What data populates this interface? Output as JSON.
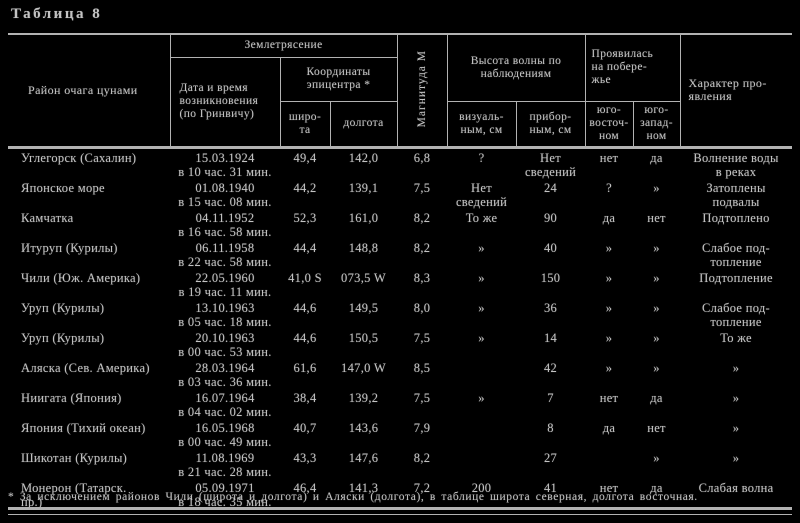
{
  "title": "Таблица 8",
  "colors": {
    "background": "#000000",
    "ink": "#c3c3c3",
    "rule": "#b2b2b2"
  },
  "header": {
    "region": "Район очага цунами",
    "earthquake_group": "Землетрясение",
    "datetime": "Дата и время\nвозникновения\n(по Гринвичу)",
    "coords_group": "Координаты\nэпицентра *",
    "lat": "широ-\nта",
    "lon": "долгота",
    "magnitude": "Магнитуда М",
    "height_group": "Высота волны по\nнаблюдениям",
    "visual": "визуаль-\nным, см",
    "instrumental": "прибор-\nным, см",
    "coast_group": "Проявилась\nна побере-\nжье",
    "southeast": "юго-\nвосточ-\nном",
    "southwest": "юго-\nзапад-\nном",
    "character": "Характер про-\nявления"
  },
  "rows": [
    {
      "region": "Углегорск (Сахалин)",
      "datetime": "15.03.1924\nв 10 час. 31 мин.",
      "lat": "49,4",
      "lon": "142,0",
      "mag": "6,8",
      "visual": "?",
      "instr": "Нет\nсведений",
      "se": "нет",
      "sw": "да",
      "character": "Волнение воды\nв реках"
    },
    {
      "region": "Японское море",
      "datetime": "01.08.1940\nв 15 час. 08 мин.",
      "lat": "44,2",
      "lon": "139,1",
      "mag": "7,5",
      "visual": "Нет\nсведений",
      "instr": "24",
      "se": "?",
      "sw": "»",
      "character": "Затоплены\nподвалы"
    },
    {
      "region": "Камчатка",
      "datetime": "04.11.1952\nв 16 час. 58 мин.",
      "lat": "52,3",
      "lon": "161,0",
      "mag": "8,2",
      "visual": "То же",
      "instr": "90",
      "se": "да",
      "sw": "нет",
      "character": "Подтоплено"
    },
    {
      "region": "Итуруп (Курилы)",
      "datetime": "06.11.1958\nв 22 час. 58 мин.",
      "lat": "44,4",
      "lon": "148,8",
      "mag": "8,2",
      "visual": "»",
      "instr": "40",
      "se": "»",
      "sw": "»",
      "character": "Слабое под-\nтопление"
    },
    {
      "region": "Чили (Юж. Америка)",
      "datetime": "22.05.1960\nв 19 час. 11 мин.",
      "lat": "41,0 S",
      "lon": "073,5 W",
      "mag": "8,3",
      "visual": "»",
      "instr": "150",
      "se": "»",
      "sw": "»",
      "character": "Подтопление"
    },
    {
      "region": "Уруп (Курилы)",
      "datetime": "13.10.1963\nв 05 час. 18 мин.",
      "lat": "44,6",
      "lon": "149,5",
      "mag": "8,0",
      "visual": "»",
      "instr": "36",
      "se": "»",
      "sw": "»",
      "character": "Слабое под-\nтопление"
    },
    {
      "region": "Уруп (Курилы)",
      "datetime": "20.10.1963\nв 00 час. 53 мин.",
      "lat": "44,6",
      "lon": "150,5",
      "mag": "7,5",
      "visual": "»",
      "instr": "14",
      "se": "»",
      "sw": "»",
      "character": "То же"
    },
    {
      "region": "Аляска (Сев. Америка)",
      "datetime": "28.03.1964\nв 03 час. 36 мин.",
      "lat": "61,6",
      "lon": "147,0 W",
      "mag": "8,5",
      "visual": "",
      "instr": "42",
      "se": "»",
      "sw": "»",
      "character": "»"
    },
    {
      "region": "Ниигата (Япония)",
      "datetime": "16.07.1964\nв 04 час. 02 мин.",
      "lat": "38,4",
      "lon": "139,2",
      "mag": "7,5",
      "visual": "»",
      "instr": "7",
      "se": "нет",
      "sw": "да",
      "character": "»"
    },
    {
      "region": "Япония (Тихий океан)",
      "datetime": "16.05.1968\nв 00 час. 49 мин.",
      "lat": "40,7",
      "lon": "143,6",
      "mag": "7,9",
      "visual": "",
      "instr": "8",
      "se": "да",
      "sw": "нет",
      "character": "»"
    },
    {
      "region": "Шикотан (Курилы)",
      "datetime": "11.08.1969\nв 21 час. 28 мин.",
      "lat": "43,3",
      "lon": "147,6",
      "mag": "8,2",
      "visual": "",
      "instr": "27",
      "se": "",
      "sw": "»",
      "character": "»"
    },
    {
      "region": "Монерон (Татарск.\nпр.)",
      "datetime": "05.09.1971\nв 18 час. 35 мин.",
      "lat": "46,4",
      "lon": "141,3",
      "mag": "7,2",
      "visual": "200",
      "instr": "41",
      "se": "нет",
      "sw": "да",
      "character": "Слабая волна"
    }
  ],
  "footnote": "* За исключением районов Чили (широта и долгота) и Аляски (долгота), в таблице широта северная, долгота восточная."
}
